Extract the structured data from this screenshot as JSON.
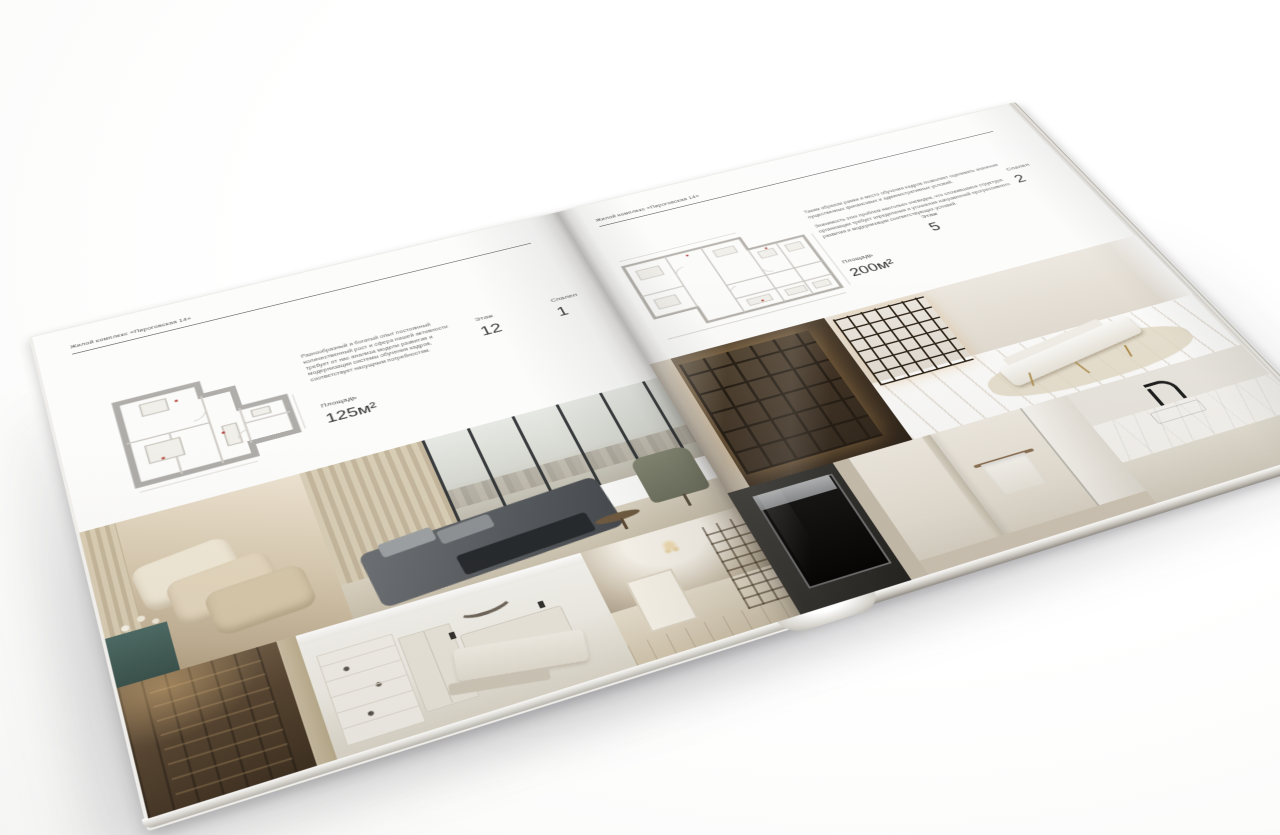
{
  "brochure": {
    "header": "Жилой комплекс «Пироговская 14»"
  },
  "left_page": {
    "header": "Жилой комплекс «Пироговская 14»",
    "description": "Разнообразный и богатый опыт постоянный количественный рост и сфера нашей активности требует от нас анализа модели развития и модернизации системы обучения кадров, соответствует насущным потребностям.",
    "specs": {
      "area_label": "Площадь",
      "area_value": "125м²",
      "floor_label": "Этаж",
      "floor_value": "12",
      "bedrooms_label": "Спален",
      "bedrooms_value": "1"
    }
  },
  "right_page": {
    "header": "Жилой комплекс «Пироговская 14»",
    "description_1": "Таким образом рамки и место обучения кадров позволяет оценивать значение существенных финансовых и административных условий.",
    "description_2": "Значимость этих проблем настолько очевидна, что сложившаяся структура организации требует определения и уточнения направлений прогрессивного развития и модернизации соответствующих условий.",
    "specs": {
      "area_label": "Площадь",
      "area_value": "200м²",
      "floor_label": "Этаж",
      "floor_value": "5",
      "bedrooms_label": "Спален",
      "bedrooms_value": "2"
    }
  },
  "palette": {
    "page_background": "#fcfcfb",
    "header_rule": "#4a4a4a",
    "plan_wall_gray": "#aeaca8",
    "plan_mark_red": "#b5493f",
    "photo_warm_beige": "#cdbda4",
    "shelf_glow_amber": "#c99d5e",
    "nightstand_teal": "#43605c",
    "bed_dark_gray": "#565a5e"
  }
}
